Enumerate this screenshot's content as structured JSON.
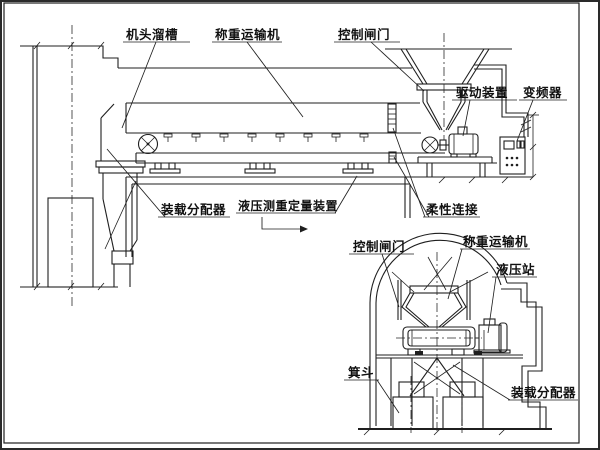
{
  "diagram": {
    "background": "#ffffff",
    "line_color": "#1f1f1f",
    "text_color": "#111111",
    "main_view": {
      "description": "side elevation of weighing conveyor loading system",
      "labels": {
        "head_chute": "机头溜槽",
        "weighing_conveyor": "称重运输机",
        "control_gate": "控制闸门",
        "drive_unit": "驱动装置",
        "frequency_converter": "变频器",
        "loading_distributor": "装载分配器",
        "hydraulic_weighing_device": "液压测重定量装置",
        "flexible_connection": "柔性连接"
      }
    },
    "inset_view": {
      "description": "cross-section of arch chamber with skip loading",
      "labels": {
        "control_gate": "控制闸门",
        "weighing_conveyor": "称重运输机",
        "hydraulic_station": "液压站",
        "skip_bucket": "箕斗",
        "loading_distributor": "装载分配器"
      }
    }
  }
}
